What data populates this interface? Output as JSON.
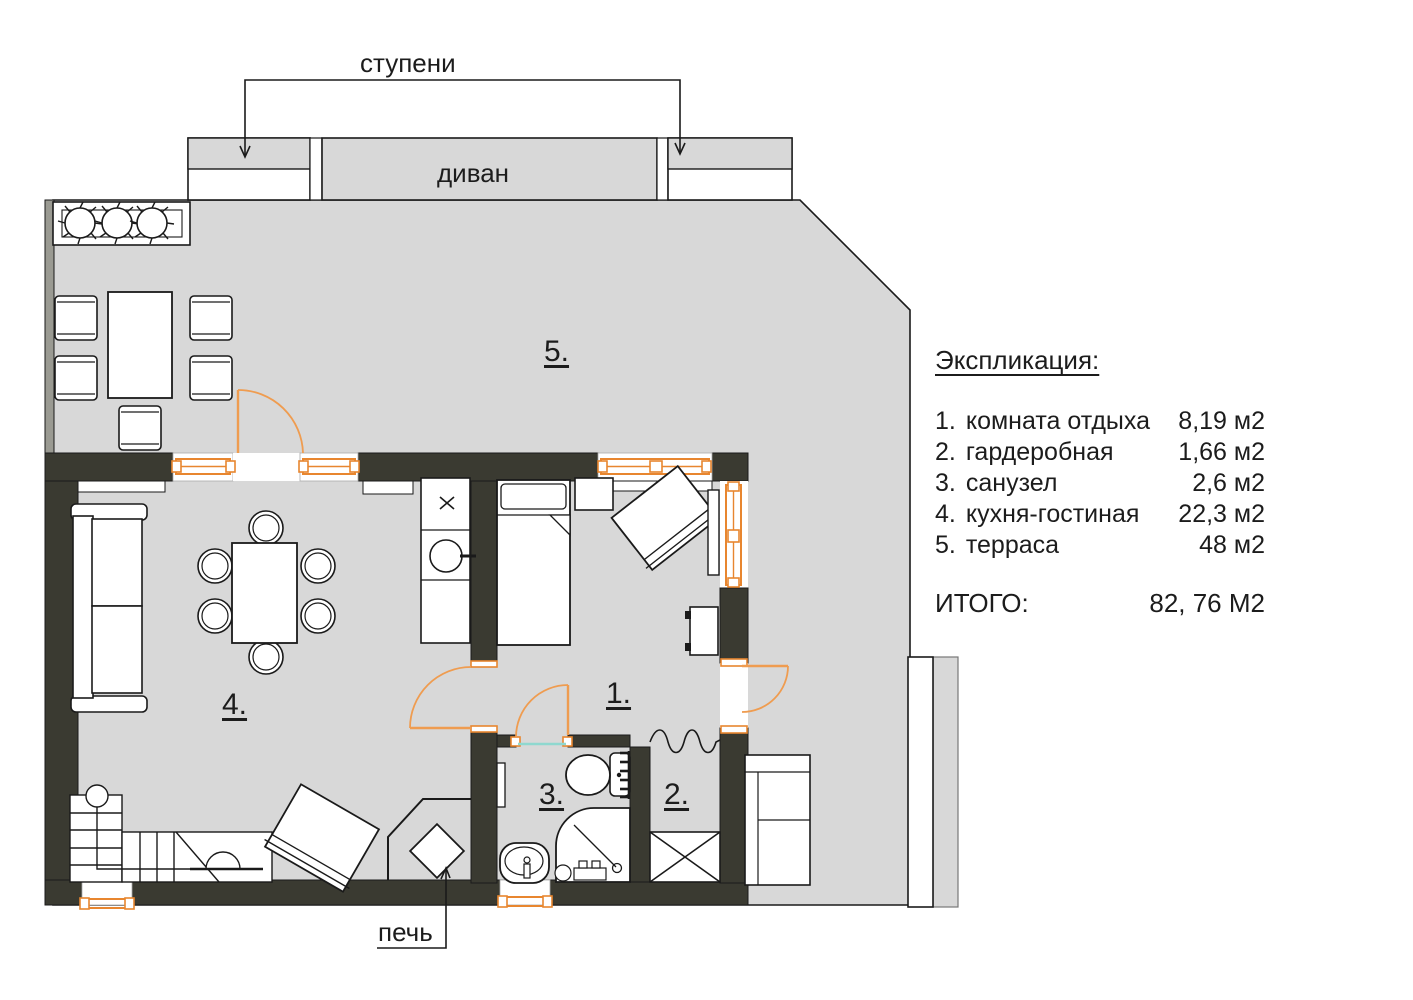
{
  "plan": {
    "annotations": {
      "steps_label": "ступени",
      "sofa_label": "диван",
      "stove_label": "печь"
    },
    "room_markers": [
      {
        "label": "5."
      },
      {
        "label": "4."
      },
      {
        "label": "1."
      },
      {
        "label": "3."
      },
      {
        "label": "2."
      }
    ],
    "colors": {
      "floor": "#d8d8d8",
      "wall": "#3a3a31",
      "frame_orange": "#e8862f",
      "door_arc_orange": "#ef9c50",
      "threshold_teal": "#8fd8cf",
      "outline": "#1a1a1a"
    }
  },
  "legend": {
    "title": "Экспликация:",
    "items": [
      {
        "num": "1.",
        "name": "комната отдыха",
        "area": "8,19 м2"
      },
      {
        "num": "2.",
        "name": "гардеробная",
        "area": "1,66 м2"
      },
      {
        "num": "3.",
        "name": "санузел",
        "area": "2,6 м2"
      },
      {
        "num": "4.",
        "name": "кухня-гостиная",
        "area": "22,3 м2"
      },
      {
        "num": "5.",
        "name": "терраса",
        "area": "48 м2"
      }
    ],
    "total_label": "ИТОГО:",
    "total_value": "82, 76 М2"
  }
}
